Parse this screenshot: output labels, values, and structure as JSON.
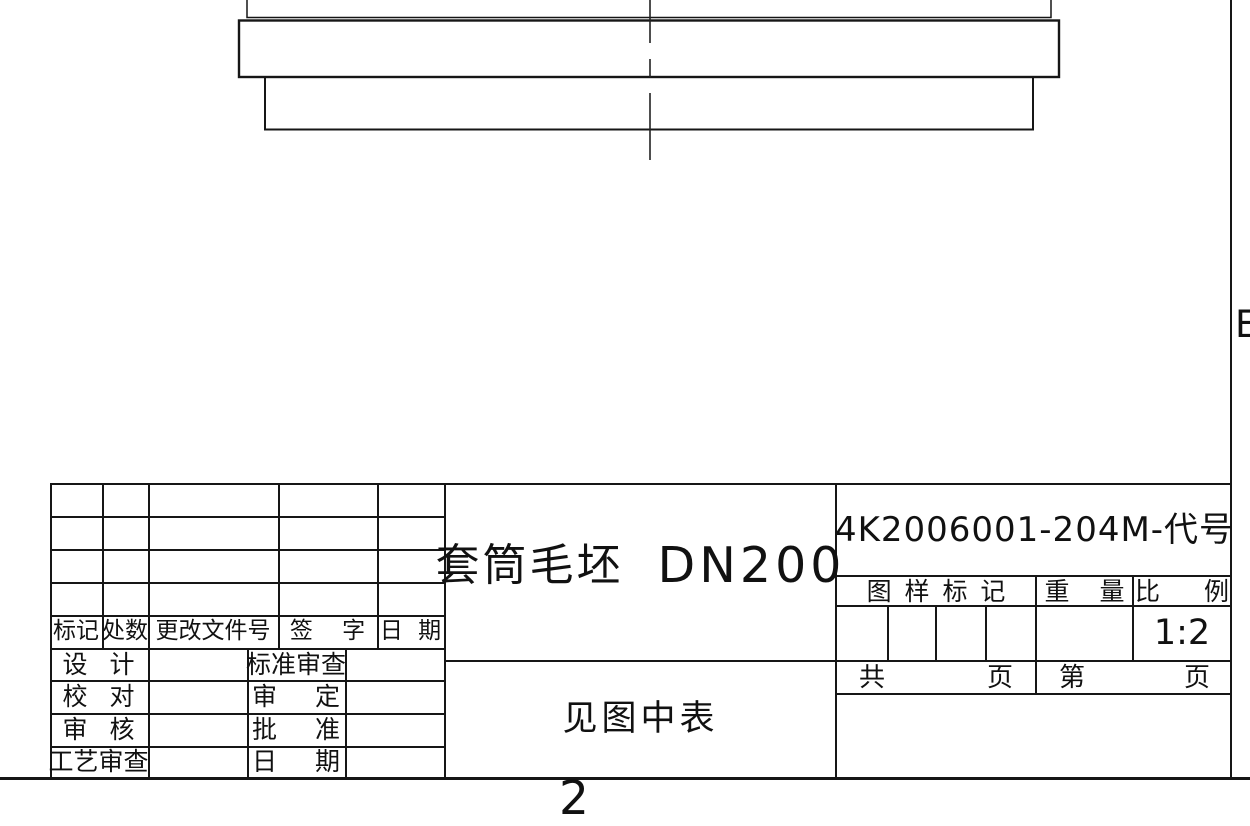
{
  "frame": {
    "zone_label": "E",
    "sheet_number": "2"
  },
  "part_view": {
    "description": "sleeve-blank-partial-section"
  },
  "title_block": {
    "part_name": "套筒毛坯",
    "part_spec": "DN200",
    "drawing_code": "4K2006001-204M-代号",
    "material_note": "见图中表",
    "stamp_header": "图 样 标 记",
    "weight_header": "重 量",
    "scale_header": "比 例",
    "scale_value": "1:2",
    "sheets_total_label": "共",
    "sheets_total_unit": "页",
    "sheet_no_label": "第",
    "sheet_no_unit": "页",
    "revision": {
      "mark": "标记",
      "count": "处数",
      "doc_no": "更改文件号",
      "signature": "签 字",
      "date": "日 期"
    },
    "signoff": [
      {
        "left": "设 计",
        "right": "标准审查"
      },
      {
        "left": "校 对",
        "right": "审 定"
      },
      {
        "left": "审 核",
        "right": "批 准"
      },
      {
        "left": "工艺审查",
        "right": "日 期"
      }
    ]
  }
}
